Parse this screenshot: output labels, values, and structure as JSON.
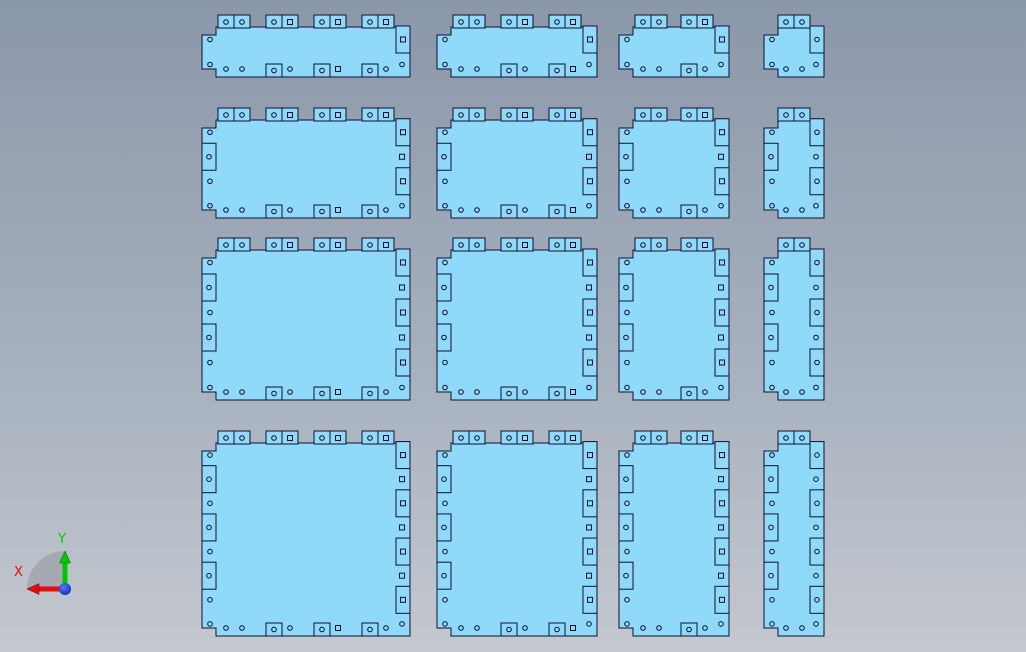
{
  "viewport": {
    "width": 1026,
    "height": 652,
    "background_top": "#8B97AA",
    "background_mid": "#A6B0BE",
    "background_bottom": "#C4C8CF"
  },
  "plates": {
    "fill": "#8FD9FB",
    "outline": "#10102A",
    "columns": [
      {
        "x": 202,
        "w": 208,
        "tab_pairs": 4
      },
      {
        "x": 437,
        "w": 160,
        "tab_pairs": 3
      },
      {
        "x": 619,
        "w": 110,
        "tab_pairs": 2
      },
      {
        "x": 764,
        "w": 60,
        "tab_pairs": 1
      }
    ],
    "rows": [
      {
        "y": 15,
        "h": 62,
        "side_units": 2
      },
      {
        "y": 108,
        "h": 110,
        "side_units": 4
      },
      {
        "y": 238,
        "h": 162,
        "side_units": 6
      },
      {
        "y": 431,
        "h": 205,
        "side_units": 8
      }
    ],
    "tab": {
      "width": 16,
      "height": 12,
      "margin": 16
    },
    "side_rect": {
      "width": 14,
      "height": 27
    },
    "bottom_rect_height": 13,
    "corner_notch": {
      "width": 14,
      "height": 8
    },
    "hole": {
      "radius": 2.3,
      "square": 5
    }
  },
  "triad": {
    "x_label": "X",
    "y_label": "Y",
    "x_axis_color": "#E01010",
    "y_axis_color": "#00C800",
    "origin_color": "#2240DF",
    "sector_color": "#9EA2A9",
    "origin_x": 65,
    "origin_y": 589,
    "axis_length": 38,
    "x_label_x": 14,
    "x_label_y": 576,
    "y_label_x": 58,
    "y_label_y": 543
  }
}
